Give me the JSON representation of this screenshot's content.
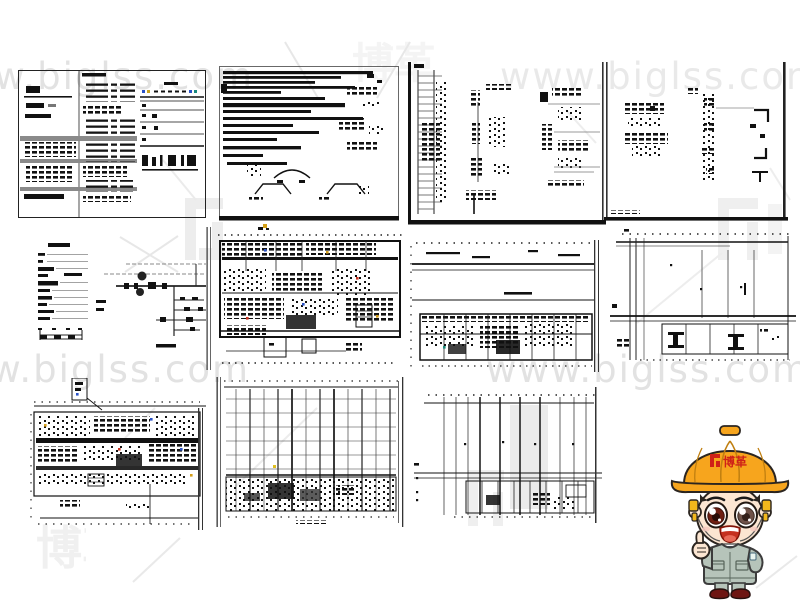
{
  "watermark": {
    "url": "www.biglss.com",
    "brand": "博革",
    "text_color": "#e2e2e2",
    "brand_mark_color": "#ededed"
  },
  "mascot": {
    "helmet_label": "博革",
    "helmet_color": "#F7A51D",
    "logo_color": "#CF2218",
    "uniform_color": "#B6C4BA",
    "shoe_color": "#6E1512",
    "skin_color": "#FCE6D2"
  },
  "sheets": [
    {
      "id": "sheet-01",
      "kind": "specification-table-sheet"
    },
    {
      "id": "sheet-02",
      "kind": "notes-and-details-sheet"
    },
    {
      "id": "sheet-03",
      "kind": "riser-schematic-sheet"
    },
    {
      "id": "sheet-04",
      "kind": "detail-sheet"
    },
    {
      "id": "sheet-05",
      "kind": "legend-list"
    },
    {
      "id": "sheet-06",
      "kind": "system-schematic"
    },
    {
      "id": "sheet-07",
      "kind": "floor-plan"
    },
    {
      "id": "sheet-08",
      "kind": "long-floor-plan"
    },
    {
      "id": "sheet-09",
      "kind": "partial-grid-plan"
    },
    {
      "id": "sheet-10",
      "kind": "dense-floor-plan"
    },
    {
      "id": "sheet-11",
      "kind": "grid-plan"
    },
    {
      "id": "sheet-12",
      "kind": "grid-plan-2"
    }
  ]
}
